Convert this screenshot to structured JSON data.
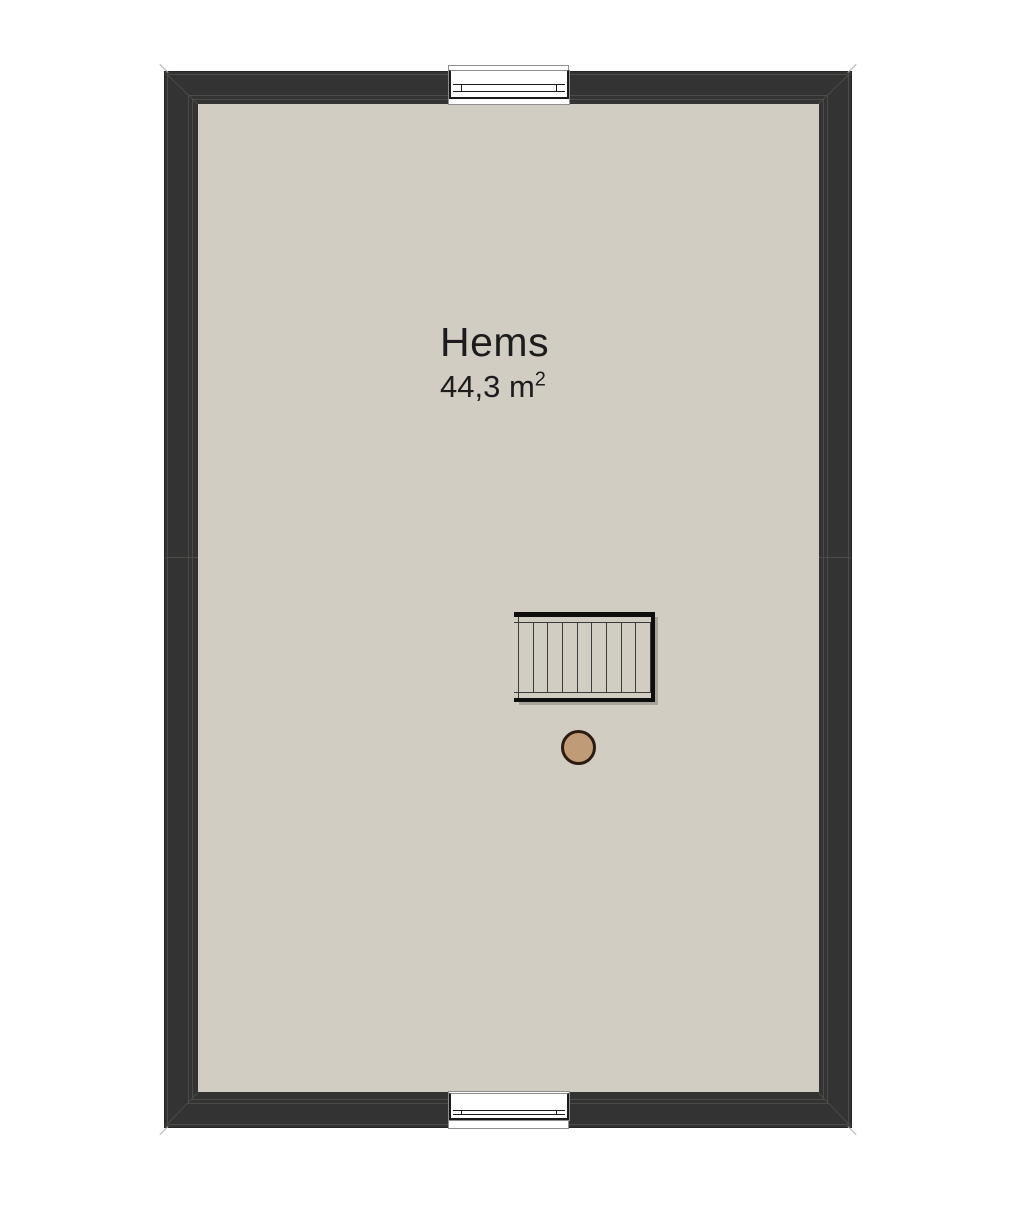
{
  "plan": {
    "title": "attic floor plan",
    "room": {
      "name": "Hems",
      "area_value": "44,3 m",
      "area_exponent": "2"
    },
    "stair": {
      "treads": 9
    },
    "icons": {
      "window_top": "window-symbol",
      "window_bottom": "window-symbol",
      "stair": "staircase-symbol",
      "post": "round-post-symbol"
    },
    "colors": {
      "background": "#ffffff",
      "wall": "#333333",
      "wall_line": "#4b4c46",
      "floor": "#d2cdc3",
      "stair_border": "#0e0e0e",
      "shadow": "#a9a49b",
      "window_frame": "#1a1a1a",
      "post_fill": "#c09b77",
      "post_border": "#2b1b10",
      "text": "#1c1c1c"
    }
  }
}
